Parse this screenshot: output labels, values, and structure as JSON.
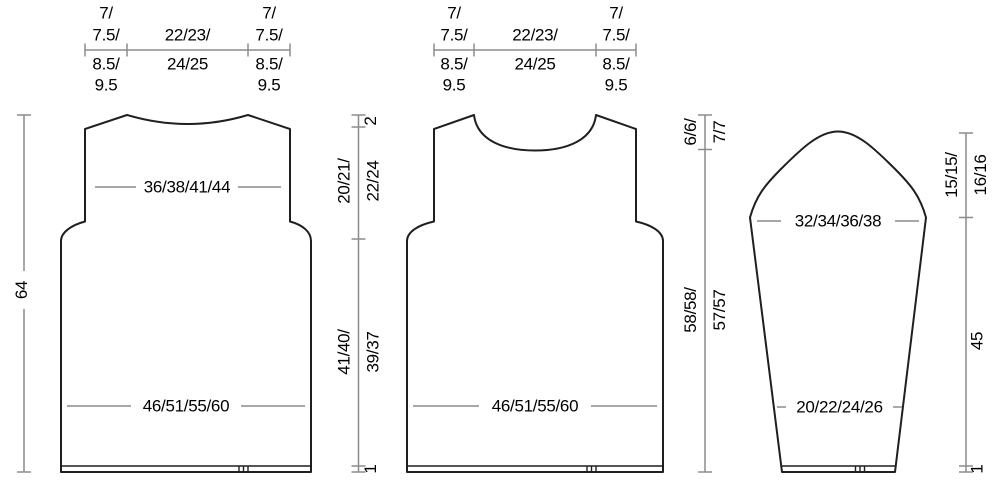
{
  "colors": {
    "background": "#ffffff",
    "outline": "#1f1f1f",
    "dimension_lines": "#8c8c8c",
    "text": "#000000"
  },
  "back": {
    "top_bar": {
      "shoulder_row1": "7/",
      "shoulder_row2": "7.5/",
      "shoulder_row3": "8.5/",
      "shoulder_row4": "9.5",
      "neck_row1": "22/23/",
      "neck_row2": "24/25"
    },
    "chest_width": "36/38/41/44",
    "hem_width": "46/51/55/60",
    "total_height": "64",
    "back_neck_depth": "2",
    "armhole_depth_row1": "20/21/",
    "armhole_depth_row2": "22/24",
    "body_height_row1": "41/40/",
    "body_height_row2": "39/37",
    "hem_band_height": "1"
  },
  "front": {
    "top_bar": {
      "shoulder_row1": "7/",
      "shoulder_row2": "7.5/",
      "shoulder_row3": "8.5/",
      "shoulder_row4": "9.5",
      "neck_row1": "22/23/",
      "neck_row2": "24/25"
    },
    "hem_width": "46/51/55/60",
    "neck_depth_row1": "6/6/",
    "neck_depth_row2": "7/7",
    "side_height_row1": "58/58/",
    "side_height_row2": "57/57"
  },
  "sleeve": {
    "upper_width": "32/34/36/38",
    "cuff_width": "20/22/24/26",
    "cap_height_row1": "15/15/",
    "cap_height_row2": "16/16",
    "underarm_length": "45",
    "cuff_band_height": "1"
  }
}
